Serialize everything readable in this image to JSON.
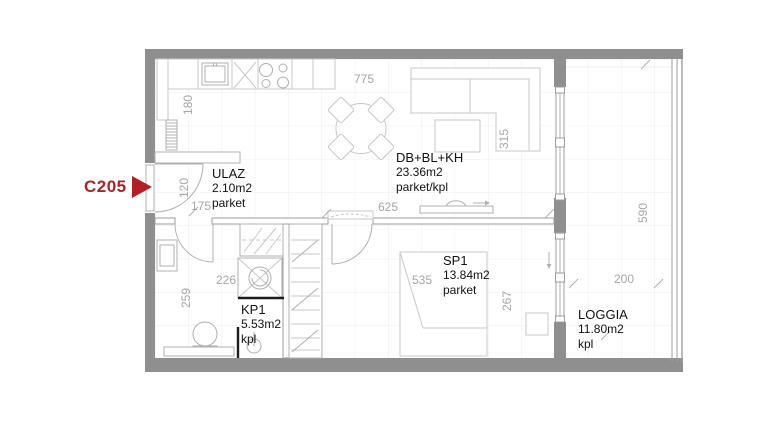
{
  "unit": {
    "code": "C205"
  },
  "rooms": {
    "ulaz": {
      "name": "ULAZ",
      "area": "2.10m2",
      "floor": "parket"
    },
    "living": {
      "name": "DB+BL+KH",
      "area": "23.36m2",
      "floor": "parket/kpl"
    },
    "bedroom": {
      "name": "SP1",
      "area": "13.84m2",
      "floor": "parket"
    },
    "bath": {
      "name": "KP1",
      "area": "5.53m2",
      "floor": "kpl"
    },
    "loggia": {
      "name": "LOGGIA",
      "area": "11.80m2",
      "floor": "kpl"
    }
  },
  "dims": {
    "d775": "775",
    "d180": "180",
    "d120": "120",
    "d175": "175",
    "d625": "625",
    "d315": "315",
    "d590": "590",
    "d200": "200",
    "d535": "535",
    "d267": "267",
    "d226": "226",
    "d259": "259"
  },
  "colors": {
    "accent": "#b02025",
    "wall": "#8f8f8f",
    "wall_outline": "#9e9e9e",
    "furniture_line": "#c8c8c8",
    "fixture_line": "#b0b0b0",
    "grid_line": "#ececec",
    "dim_text": "#a6a6a6",
    "label_text": "#121212"
  }
}
